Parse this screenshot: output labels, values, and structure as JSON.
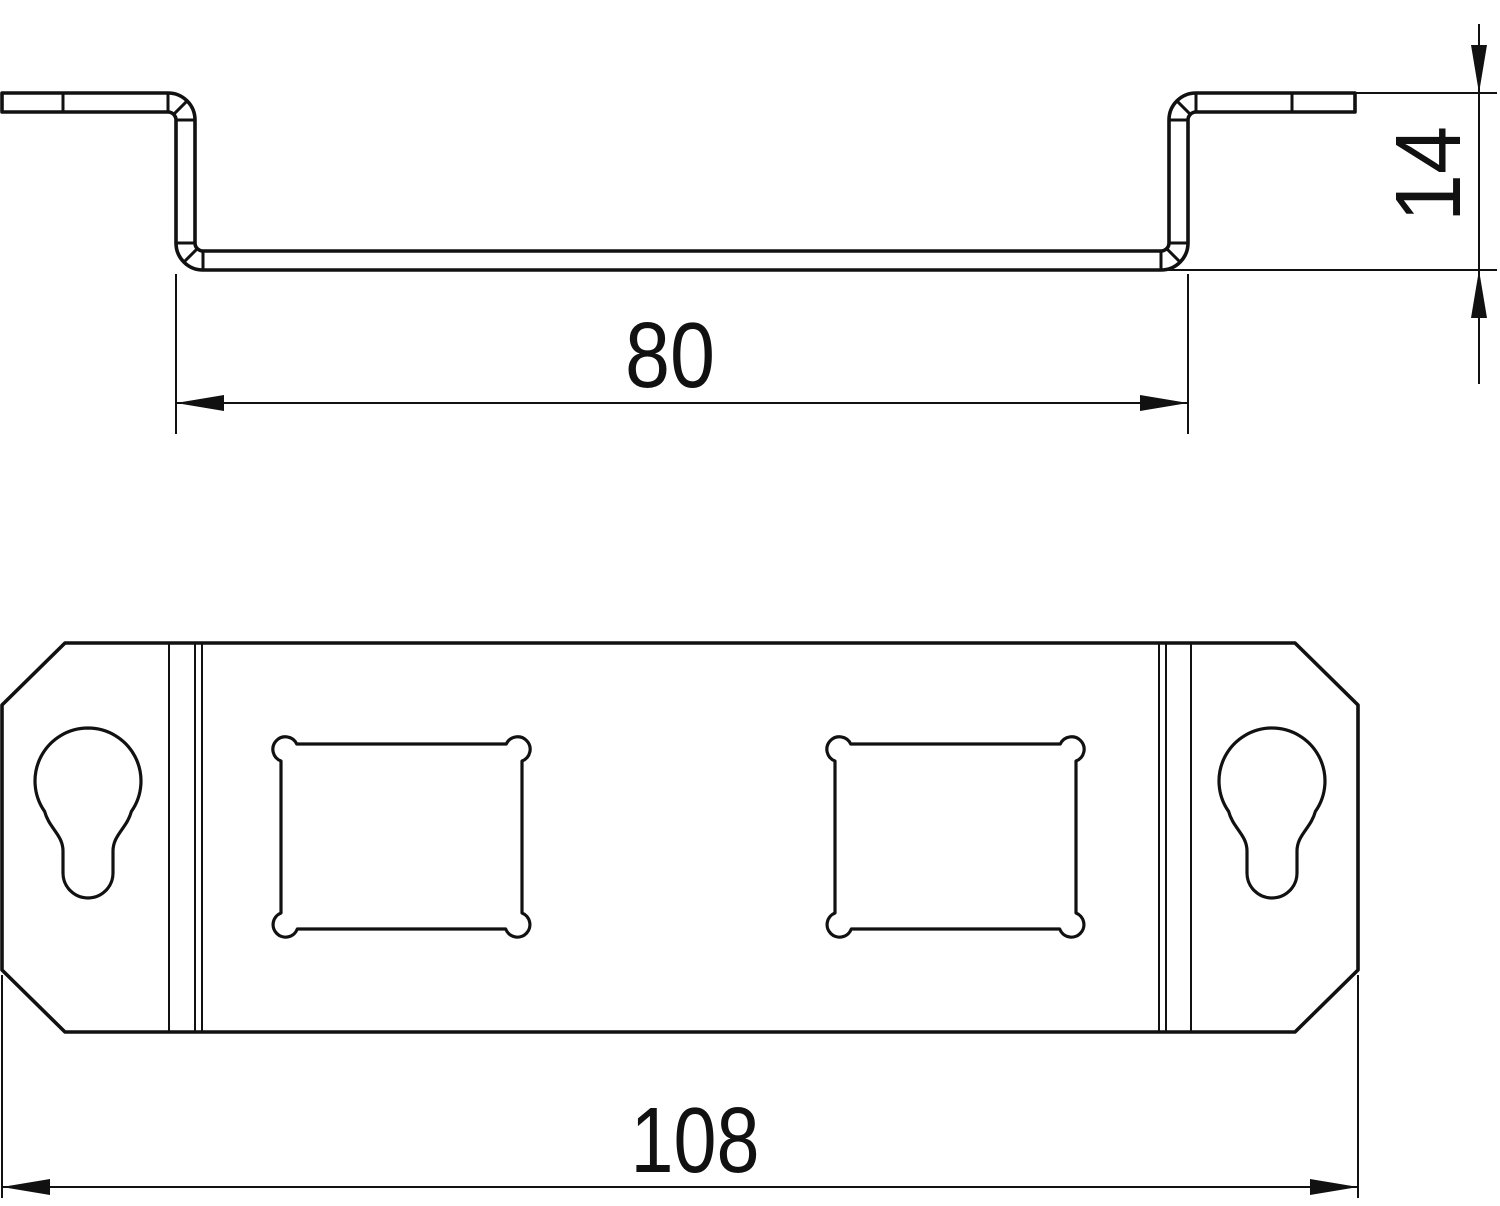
{
  "page": {
    "background_color": "#ffffff",
    "line_color": "#111111"
  },
  "views": {
    "profile": {
      "label": "profile-section-view",
      "dimensions": {
        "opening_width": {
          "value": "80"
        },
        "height": {
          "value": "14"
        }
      }
    },
    "plan": {
      "label": "plan-view",
      "dimensions": {
        "overall_width": {
          "value": "108"
        }
      }
    }
  }
}
